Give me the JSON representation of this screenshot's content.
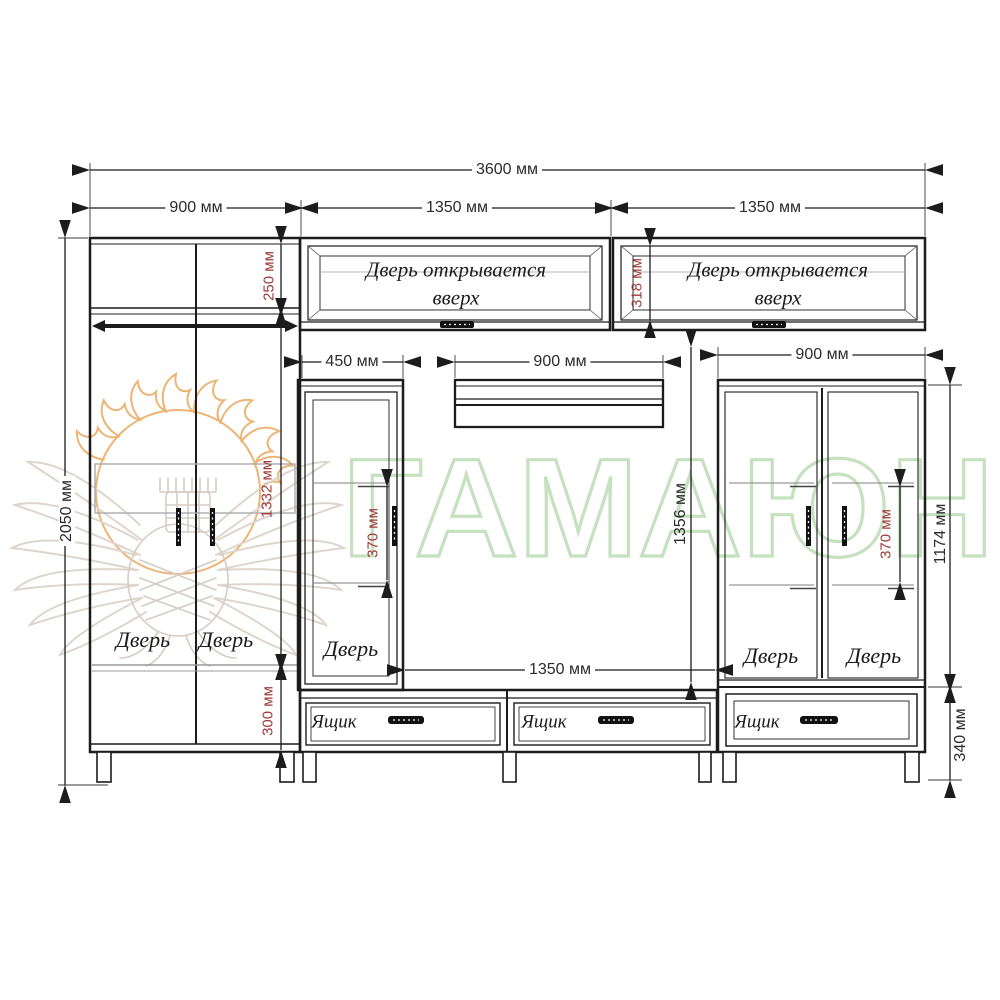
{
  "watermark": {
    "brand": "ГАМАЮН"
  },
  "labels": {
    "door": "Дверь",
    "drawer": "Ящик",
    "flip_door_line1": "Дверь открывается",
    "flip_door_line2": "вверх"
  },
  "dimensions": {
    "total_width": "3600 мм",
    "left_section_width": "900 мм",
    "middle_section_width": "1350 мм",
    "right_section_width": "1350 мм",
    "total_height": "2050 мм",
    "glass_door_width": "450 мм",
    "wall_shelf_width": "900 мм",
    "right_cabinet_width": "900 мм",
    "left_top_height": "250 мм",
    "flip_door_height": "318 мм",
    "left_door_height": "1332 мм",
    "left_bottom_height": "300 мм",
    "glass_shelf_gap": "370 мм",
    "right_shelf_gap": "370 мм",
    "middle_opening_height": "1356 мм",
    "right_door_height": "1174 мм",
    "drawer_section_height": "340 мм",
    "middle_opening_width": "1350 мм"
  },
  "colors": {
    "line": "#1c1c1c",
    "dim_red": "#a03a3a",
    "watermark_green": "#b3d8ab",
    "logo_sepia": "#d9cec5",
    "logo_orange": "#e9a85d"
  }
}
